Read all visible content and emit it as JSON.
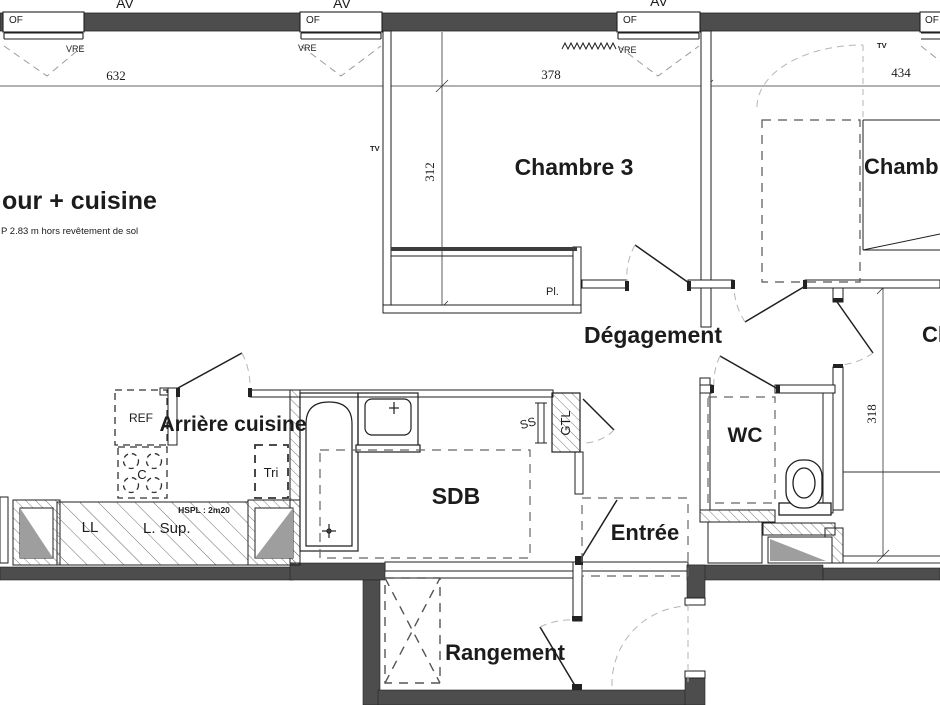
{
  "rooms": {
    "sejour": "our + cuisine",
    "sejour_note": "P 2.83 m hors revêtement de sol",
    "chambre3": "Chambre 3",
    "chambre_haut_droite": "Chambre",
    "chambre_bas_droite": "Ch",
    "degagement": "Dégagement",
    "arriere_cuisine": "Arrière cuisine",
    "sdb": "SDB",
    "wc": "WC",
    "entree": "Entrée",
    "rangement": "Rangement"
  },
  "dimensions": {
    "w1": "632",
    "w2": "378",
    "w3": "434",
    "h1": "312",
    "h2": "318"
  },
  "annotations": {
    "av": "AV",
    "of": "OF",
    "vre": "VRE",
    "tv": "TV",
    "pl": "Pl.",
    "ref": "REF",
    "cuisson": "C",
    "tri": "Tri",
    "ss": "SS",
    "gtl": "GTL",
    "ll": "LL",
    "l_sup": "L. Sup.",
    "hspl": "HSPL : 2m20"
  },
  "colors": {
    "wall": "#4d4d4d",
    "line": "#1f1f1f",
    "swing": "#b5b5b5",
    "shaft": "#9e9e9e"
  }
}
